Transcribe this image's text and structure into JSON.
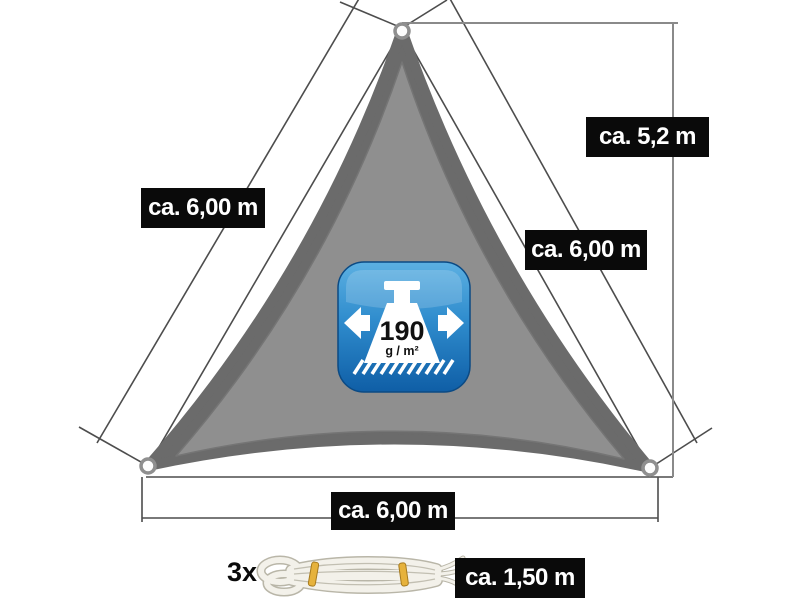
{
  "diagram": {
    "dimension_labels": {
      "left_side": "ca. 6,00 m",
      "height": "ca. 5,2 m",
      "right_side": "ca. 6,00 m",
      "bottom_side": "ca. 6,00 m"
    },
    "rope": {
      "count": "3x",
      "length": "ca. 1,50 m"
    },
    "weight_badge": {
      "value": "190",
      "unit": "g / m²"
    },
    "colors": {
      "sail_outer": "#6b6b6b",
      "sail_inner": "#8f8f8f",
      "label_background": "#0a0a0a",
      "label_text": "#ffffff",
      "badge_blue_top": "#5cb0e2",
      "badge_blue_bottom": "#0f5ea6",
      "rope_tie_yellow": "#e6b23c",
      "line": "#4d4d4d"
    }
  }
}
